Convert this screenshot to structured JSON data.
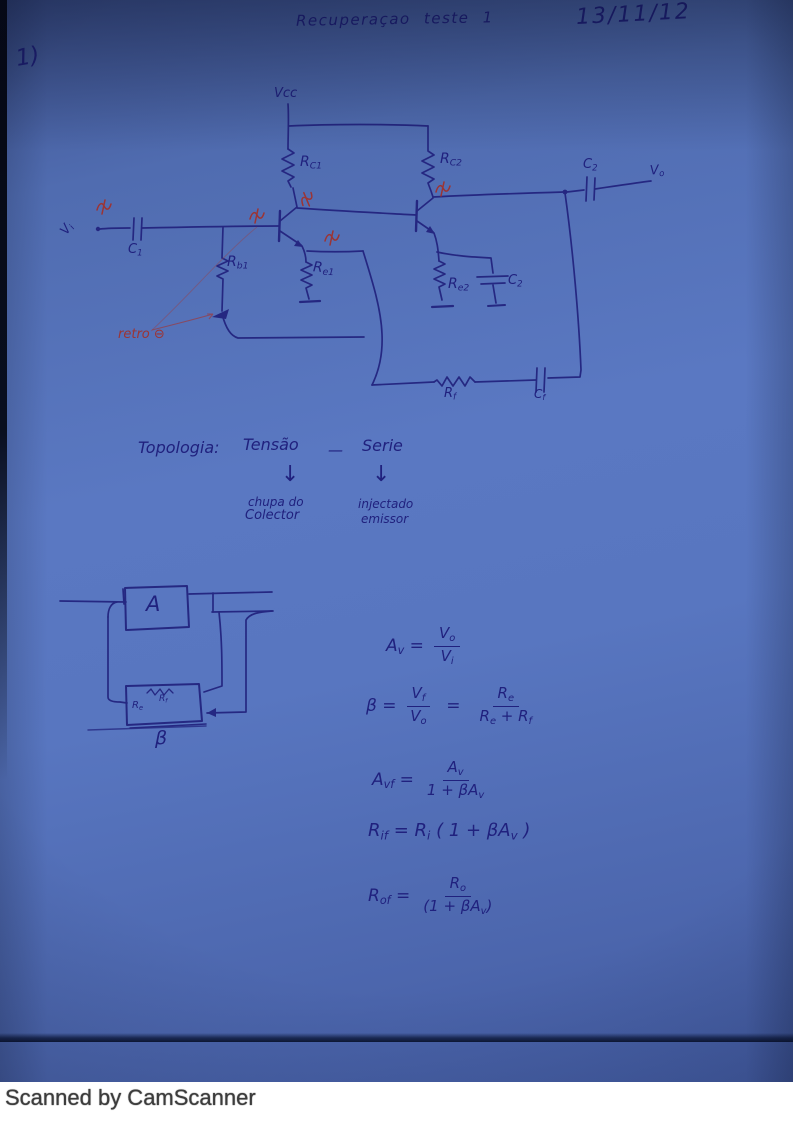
{
  "ink": {
    "blue": "#20217e",
    "red": "#9c3434"
  },
  "page": {
    "number": "1)",
    "title": "Recuperaçao  teste 1",
    "date": "13/11/12",
    "footer": "Scanned by CamScanner"
  },
  "circuit": {
    "vcc": "Vcc",
    "rc1": "R_{C1}",
    "rc2": "R_{C2}",
    "c1": "C_{1}",
    "c2_out": "C_{2}",
    "vo": "V_{o}",
    "vi": "V_{i}",
    "rb1": "R_{b1}",
    "re1": "R_{e1}",
    "re2": "R_{e2}",
    "ce2": "C_{2}",
    "rf": "R_{f}",
    "cf": "C_{f}",
    "retro": "retro ⊖"
  },
  "topology": {
    "heading": "Topologia:",
    "type": "Tensão",
    "dash": "—",
    "mode": "Serie",
    "arrow": "↓",
    "left_note_line1": "chupa do",
    "left_note_line2": "Colector",
    "right_note_line1": "injectado",
    "right_note_line2": "emissor"
  },
  "block_diagram": {
    "amplifier": "A",
    "feedback": "β",
    "inner_rf": "R_{f}",
    "inner_re": "R_{e}"
  },
  "formulas": {
    "f1_lhs": "A_{v} =",
    "f1_num": "V_{o}",
    "f1_den": "V_{i}",
    "f2_lhs": "β =",
    "f2_num1": "V_{f}",
    "f2_den1": "V_{o}",
    "f2_eq": "=",
    "f2_num2": "R_{e}",
    "f2_den2": "R_{e} + R_{f}",
    "f3_lhs": "A_{vf} =",
    "f3_num": "A_{v}",
    "f3_den": "1 + βA_{v}",
    "f4": "R_{if} = R_{i} ( 1 + βA_{v} )",
    "f5_lhs": "R_{of} =",
    "f5_num": "R_{o}",
    "f5_den": "(1 + βA_{v})"
  }
}
